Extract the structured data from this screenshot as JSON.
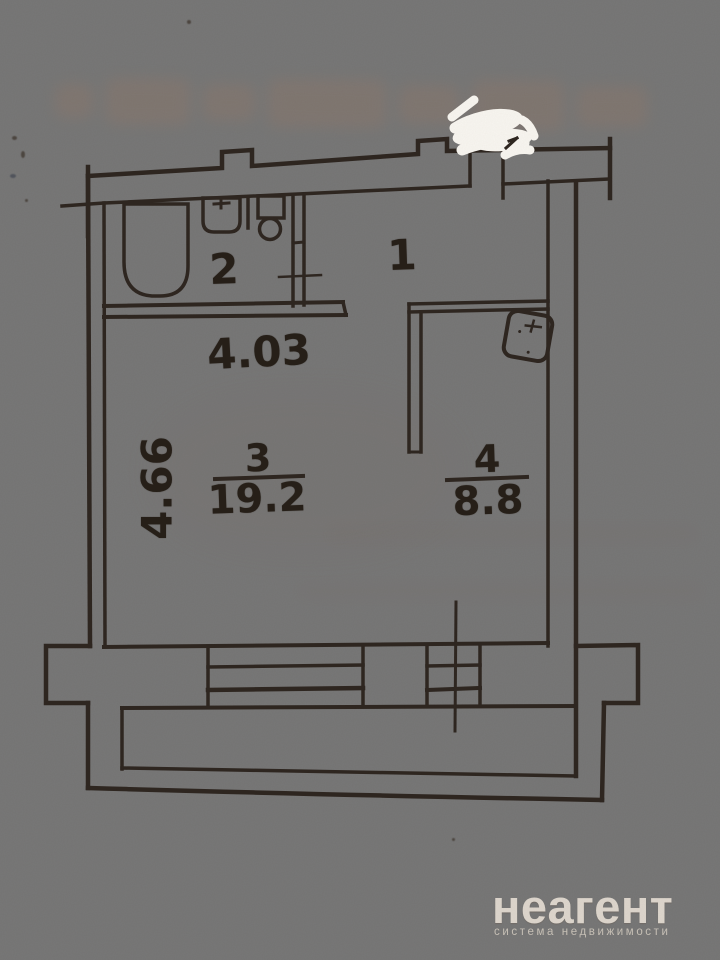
{
  "scene": {
    "description": "Photographed apartment floor plan on beige paper"
  },
  "plan": {
    "rooms": [
      {
        "number": "1"
      },
      {
        "number": "2"
      },
      {
        "number": "3",
        "area": "19.2"
      },
      {
        "number": "4",
        "area": "8.8"
      }
    ],
    "dimensions": {
      "width": "4.03",
      "height": "4.66"
    },
    "fixtures": [
      "bathtub",
      "sink",
      "toilet",
      "stove"
    ]
  },
  "watermark": {
    "brand": "неагент",
    "tagline": "система недвижимости"
  },
  "colors": {
    "ink": "#2e2620",
    "paper_light": "#d8caba",
    "paper_dark": "#917d6c",
    "watermark_text": "#e7e0d6",
    "whiteout": "#f8f6f1"
  }
}
